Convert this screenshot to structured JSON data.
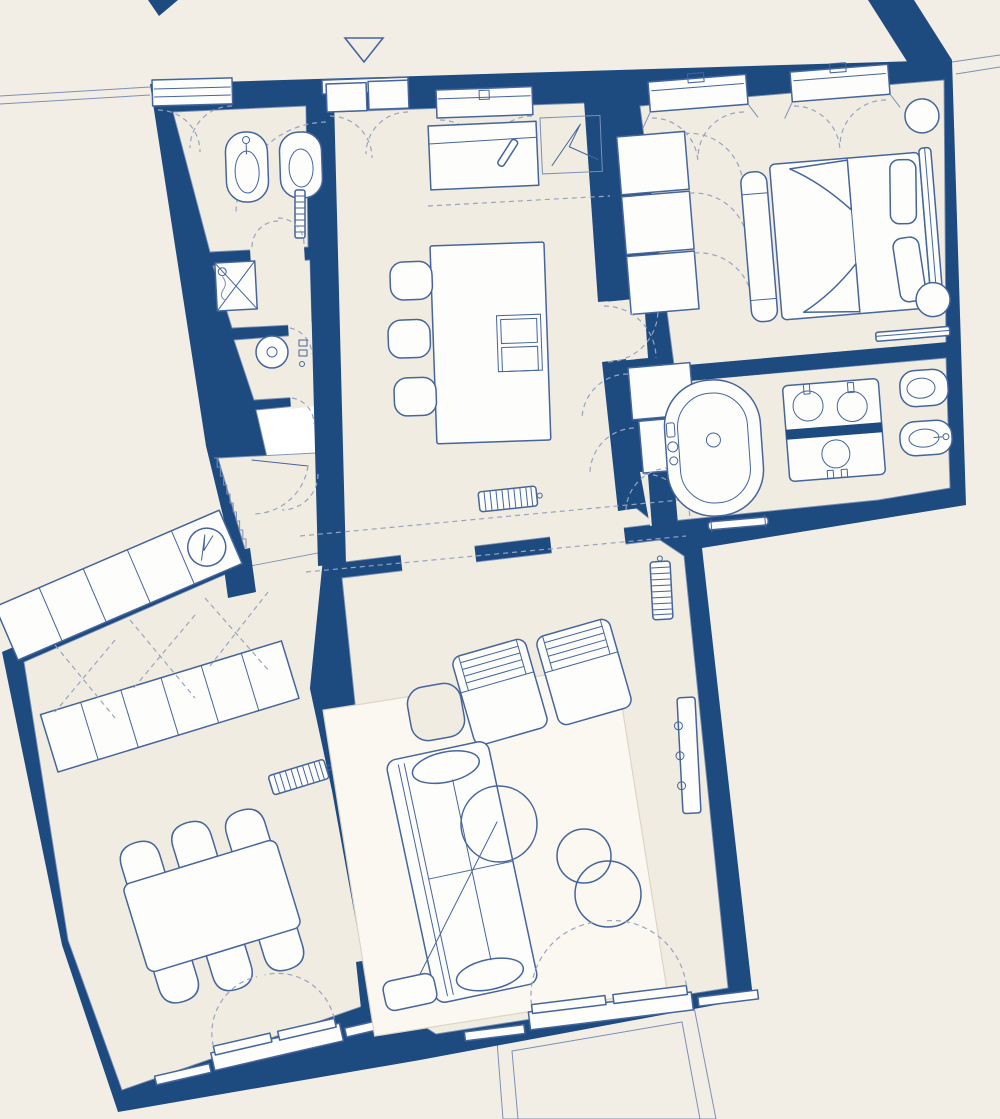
{
  "title": "Apartment floor plan — blueprint style architectural drawing",
  "drawing": {
    "kind": "architectural-floor-plan",
    "view": "top-down",
    "note": "No text labels, dimensions or numbers are printed on the plan; walls are solid navy, furniture outlined in blue, door swings dashed",
    "entrance_marker": "outlined triangle pointing down above the main entrance door at top of plan"
  },
  "colors": {
    "bg": "#f3eee5",
    "floor": "#f1ece2",
    "wall": "#1d4b80",
    "line": "#45659b",
    "dash": "#97a4c0",
    "edge": "#7b90b4",
    "white": "#fdfdfb",
    "rug": "#faf8f1"
  },
  "rooms": [
    {
      "id": "entrance-hall",
      "furniture": [
        {
          "item": "entrance-double-door",
          "count": 1
        },
        {
          "item": "entry-console-with-pen",
          "count": 1
        },
        {
          "item": "utility-panel-zigzag",
          "count": 1
        }
      ]
    },
    {
      "id": "wc",
      "furniture": [
        {
          "item": "bidet",
          "count": 1
        },
        {
          "item": "toilet",
          "count": 1
        },
        {
          "item": "towel-radiator",
          "count": 1
        },
        {
          "item": "double-swing-door",
          "count": 1
        },
        {
          "item": "window",
          "count": 1
        }
      ]
    },
    {
      "id": "shower-room",
      "furniture": [
        {
          "item": "shower-tray-with-cross",
          "count": 1
        },
        {
          "item": "hand-shower",
          "count": 1
        }
      ]
    },
    {
      "id": "laundry",
      "furniture": [
        {
          "item": "washing-machine",
          "count": 1
        },
        {
          "item": "wall-taps",
          "count": 2
        }
      ]
    },
    {
      "id": "storage",
      "furniture": []
    },
    {
      "id": "kitchen",
      "furniture": [
        {
          "item": "kitchen-island",
          "count": 1
        },
        {
          "item": "bar-stool",
          "count": 3
        },
        {
          "item": "cooktop-double",
          "count": 1
        },
        {
          "item": "radiator",
          "count": 1
        },
        {
          "item": "curtained-window",
          "count": 1
        }
      ]
    },
    {
      "id": "hallway",
      "furniture": [
        {
          "item": "sawtooth-stair-wall",
          "count": 1
        },
        {
          "item": "door-swing",
          "count": 1
        }
      ]
    },
    {
      "id": "dressing-corridor",
      "furniture": [
        {
          "item": "wardrobe-cell-top-row",
          "count": 5
        },
        {
          "item": "water-heater-circle",
          "count": 1
        },
        {
          "item": "wardrobe-cell-bottom-row",
          "count": 6
        },
        {
          "item": "folding-door-dashes",
          "count": 3
        },
        {
          "item": "radiator",
          "count": 1
        }
      ]
    },
    {
      "id": "bedroom",
      "furniture": [
        {
          "item": "double-bed",
          "count": 1
        },
        {
          "item": "pillow",
          "count": 2
        },
        {
          "item": "duvet-with-folds",
          "count": 1
        },
        {
          "item": "headboard",
          "count": 1
        },
        {
          "item": "foot-bench",
          "count": 1
        },
        {
          "item": "round-nightstand",
          "count": 2
        },
        {
          "item": "built-in-wardrobe-cell",
          "count": 3
        },
        {
          "item": "linen-closet-cell",
          "count": 2
        },
        {
          "item": "radiator",
          "count": 1
        },
        {
          "item": "curtained-window",
          "count": 2
        }
      ]
    },
    {
      "id": "bathroom",
      "furniture": [
        {
          "item": "freestanding-bathtub",
          "count": 1
        },
        {
          "item": "double-washbasin-vanity",
          "count": 1
        },
        {
          "item": "round-basin",
          "count": 1
        },
        {
          "item": "toilet",
          "count": 1
        },
        {
          "item": "bidet",
          "count": 1
        },
        {
          "item": "towel-rail",
          "count": 1
        }
      ]
    },
    {
      "id": "dining-room",
      "furniture": [
        {
          "item": "dining-table",
          "count": 1
        },
        {
          "item": "dining-chair",
          "count": 6
        },
        {
          "item": "french-window-with-shutters",
          "count": 1
        }
      ]
    },
    {
      "id": "living-room",
      "furniture": [
        {
          "item": "area-rug",
          "count": 1
        },
        {
          "item": "sofa",
          "count": 1
        },
        {
          "item": "armchair",
          "count": 2
        },
        {
          "item": "round-coffee-table",
          "count": 1
        },
        {
          "item": "nesting-side-table",
          "count": 2
        },
        {
          "item": "square-side-table",
          "count": 1
        },
        {
          "item": "arc-floor-lamp",
          "count": 1
        },
        {
          "item": "wall-console",
          "count": 1
        },
        {
          "item": "radiator",
          "count": 1
        },
        {
          "item": "french-door-with-shutters",
          "count": 1
        }
      ]
    },
    {
      "id": "terrace",
      "furniture": [
        {
          "item": "terrace-outline",
          "count": 1
        }
      ]
    }
  ],
  "openings": {
    "windows": [
      "wc-window",
      "kitchen-window",
      "bedroom-window-1",
      "bedroom-window-2"
    ],
    "french_doors": [
      "dining-french-window",
      "living-room-french-door"
    ],
    "entrance": "double-leaf entry door at top with triangle marker"
  },
  "radiator_locations": [
    "kitchen",
    "living-room",
    "dressing-corridor",
    "bedroom",
    "bathroom-towel-rail",
    "wc-towel-rail"
  ]
}
